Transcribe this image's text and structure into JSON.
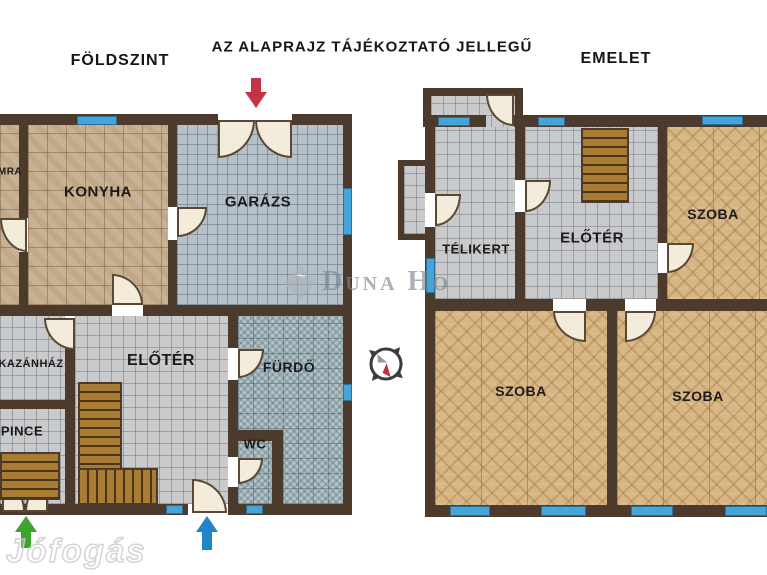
{
  "header": {
    "ground_title": "FÖLDSZINT",
    "disclaimer": "AZ ALAPRAJZ TÁJÉKOZTATÓ JELLEGŰ",
    "upper_title": "EMELET"
  },
  "ground_floor": {
    "rooms": {
      "kamra": "MRA",
      "konyha": "KONYHA",
      "garazs": "GARÁZS",
      "kazanhaz": "KAZÁNHÁZ",
      "pince": "PINCE",
      "eloter": "ELŐTÉR",
      "furdo": "FÜRDŐ",
      "wc": "WC"
    }
  },
  "upper_floor": {
    "rooms": {
      "telikert": "TÉLIKERT",
      "eloter": "ELŐTÉR",
      "szoba_top": "SZOBA",
      "szoba_bottom_left": "SZOBA",
      "szoba_bottom_right": "SZOBA"
    }
  },
  "watermarks": {
    "agency": "Duna Ho",
    "portal": "Jófogás"
  },
  "colors": {
    "wall": "#4c3a2c",
    "window": "#45a4d8",
    "door": "#f3ecda",
    "stairs": "#a87c33",
    "arrow_red": "#c53344",
    "arrow_green": "#3fa32e",
    "arrow_blue": "#1e86c8",
    "floor_beige": "#c9b294",
    "floor_gray": "#b6c0c8",
    "floor_light": "#c9cacc",
    "floor_teal": "#b3c3c8",
    "floor_parquet": "#d8b684"
  }
}
